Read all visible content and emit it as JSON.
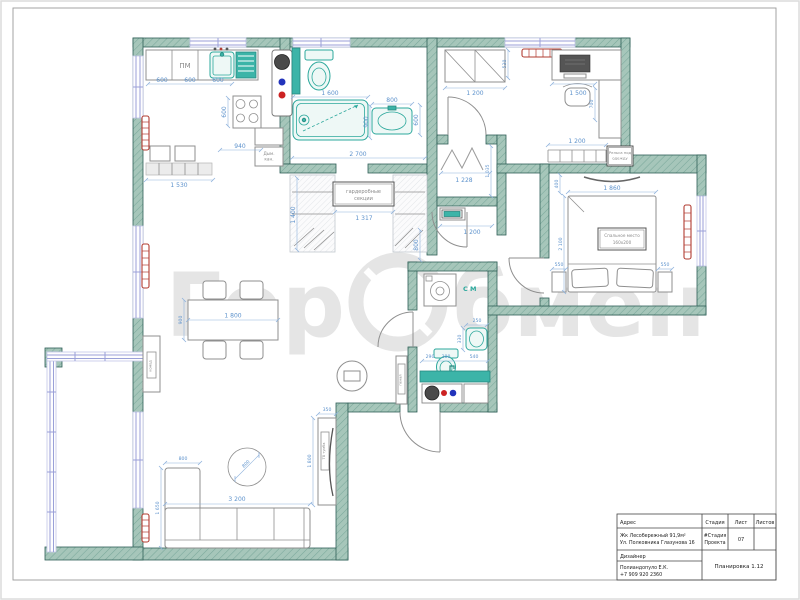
{
  "watermark": {
    "part1": "Гор",
    "part2": "бмен"
  },
  "title_block": {
    "address_label": "Адрес",
    "stage_label": "Стадия",
    "sheet_label": "Лист",
    "sheets_label": "Листов",
    "address_line1": "Жк Лесобережный 91,9м²",
    "address_line2": "Ул. Полковника Глазунова 16",
    "stage_value_line1": "#Стадия",
    "stage_value_line2": "Проекта",
    "sheet_value": "07",
    "designer_label": "Дизайнер",
    "designer_name": "Полиандопуло Е.К.",
    "designer_phone": "+7 909 920 2360",
    "drawing_name": "Планировка 1.12"
  },
  "plan": {
    "labels": {
      "dishwasher": "ПМ",
      "duct1": "Дым.",
      "duct2": "кан.",
      "ward1": "гардеробные",
      "ward2": "секции",
      "rail1": "Рельса под",
      "rail2": "одежду",
      "bed1": "Спальное место",
      "bed2": "160x200",
      "washer": "С М",
      "console": "комод",
      "tv_unit": "ТВ тумба",
      "cabinet": "пенал"
    },
    "dims": {
      "kitchen_600a": "600",
      "kitchen_600b": "600",
      "kitchen_600c": "600",
      "kitchen_600d": "600",
      "kitchen_940": "940",
      "kitchen_1530": "1 530",
      "bath_1600": "1 600",
      "bath_800": "800",
      "bath_900": "900",
      "bath_600": "600",
      "bath_2700": "2 700",
      "hall_1400": "1 400",
      "hall_1317": "1 317",
      "vest_1228": "1 228",
      "vest_1035": "1 035",
      "vest_1200": "1 200",
      "vest_800": "800",
      "office_1200a": "1 200",
      "office_530": "530",
      "office_1500": "1 500",
      "office_700": "700",
      "office_1200b": "1 200",
      "bed_1860": "1 860",
      "bed_2100": "2 100",
      "bed_550a": "550",
      "bed_550b": "550",
      "bed_400": "400",
      "wc_250": "250",
      "wc_330": "330",
      "wc_290": "290",
      "wc_380": "380",
      "wc_540": "540",
      "living_1800": "1 800",
      "living_900": "900",
      "living_rug800": "800",
      "living_chaise800": "800",
      "living_1650": "1 650",
      "living_3200": "3 200",
      "living_tv350": "350",
      "living_tv1800": "1 800"
    }
  }
}
